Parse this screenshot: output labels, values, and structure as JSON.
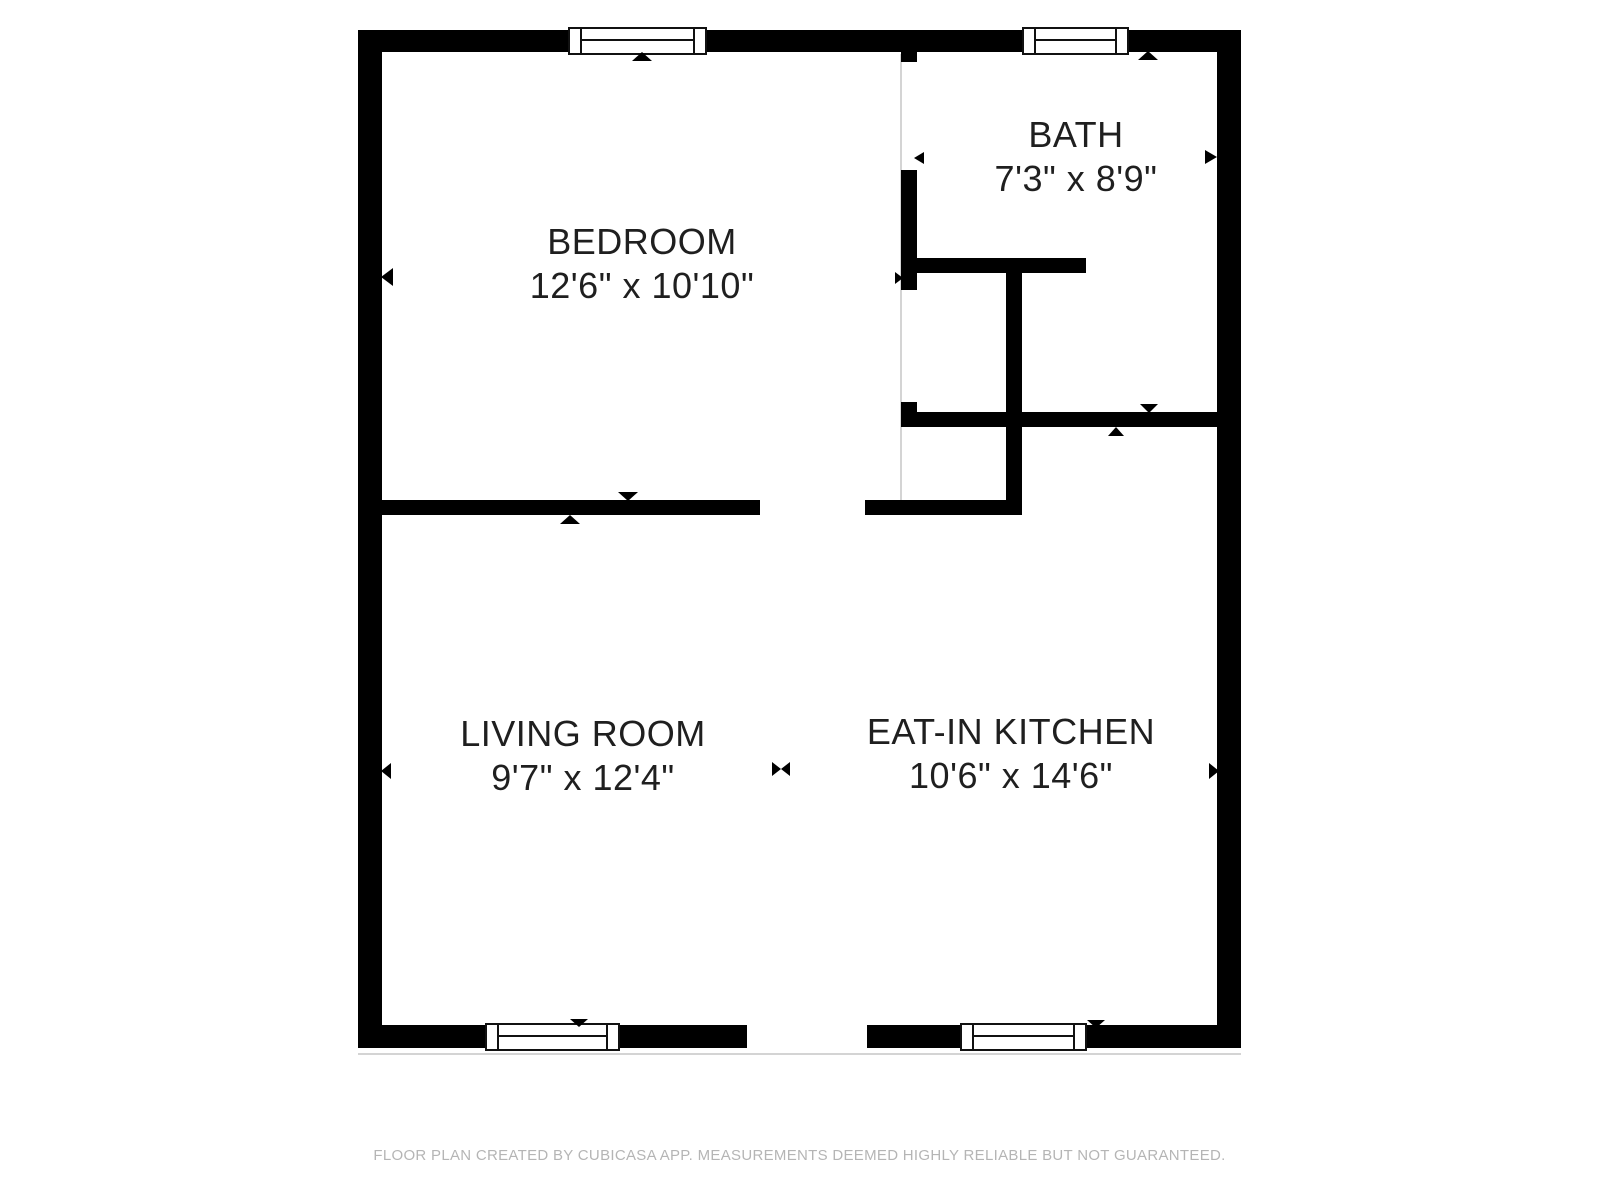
{
  "plan": {
    "rooms": [
      {
        "name": "BEDROOM",
        "dims": "12'6\" x 10'10\""
      },
      {
        "name": "BATH",
        "dims": "7'3\" x 8'9\""
      },
      {
        "name": "LIVING ROOM",
        "dims": "9'7\" x 12'4\""
      },
      {
        "name": "EAT-IN KITCHEN",
        "dims": "10'6\" x 14'6\""
      }
    ]
  },
  "footer": {
    "disclaimer": "FLOOR PLAN CREATED BY CUBICASA APP. MEASUREMENTS DEEMED HIGHLY RELIABLE BUT NOT GUARANTEED."
  },
  "colors": {
    "wall": "#000000",
    "label_text": "#1f1f1f",
    "footer_text": "#b5b5b5",
    "boundary_line": "#d4d4d4",
    "background": "#ffffff"
  }
}
